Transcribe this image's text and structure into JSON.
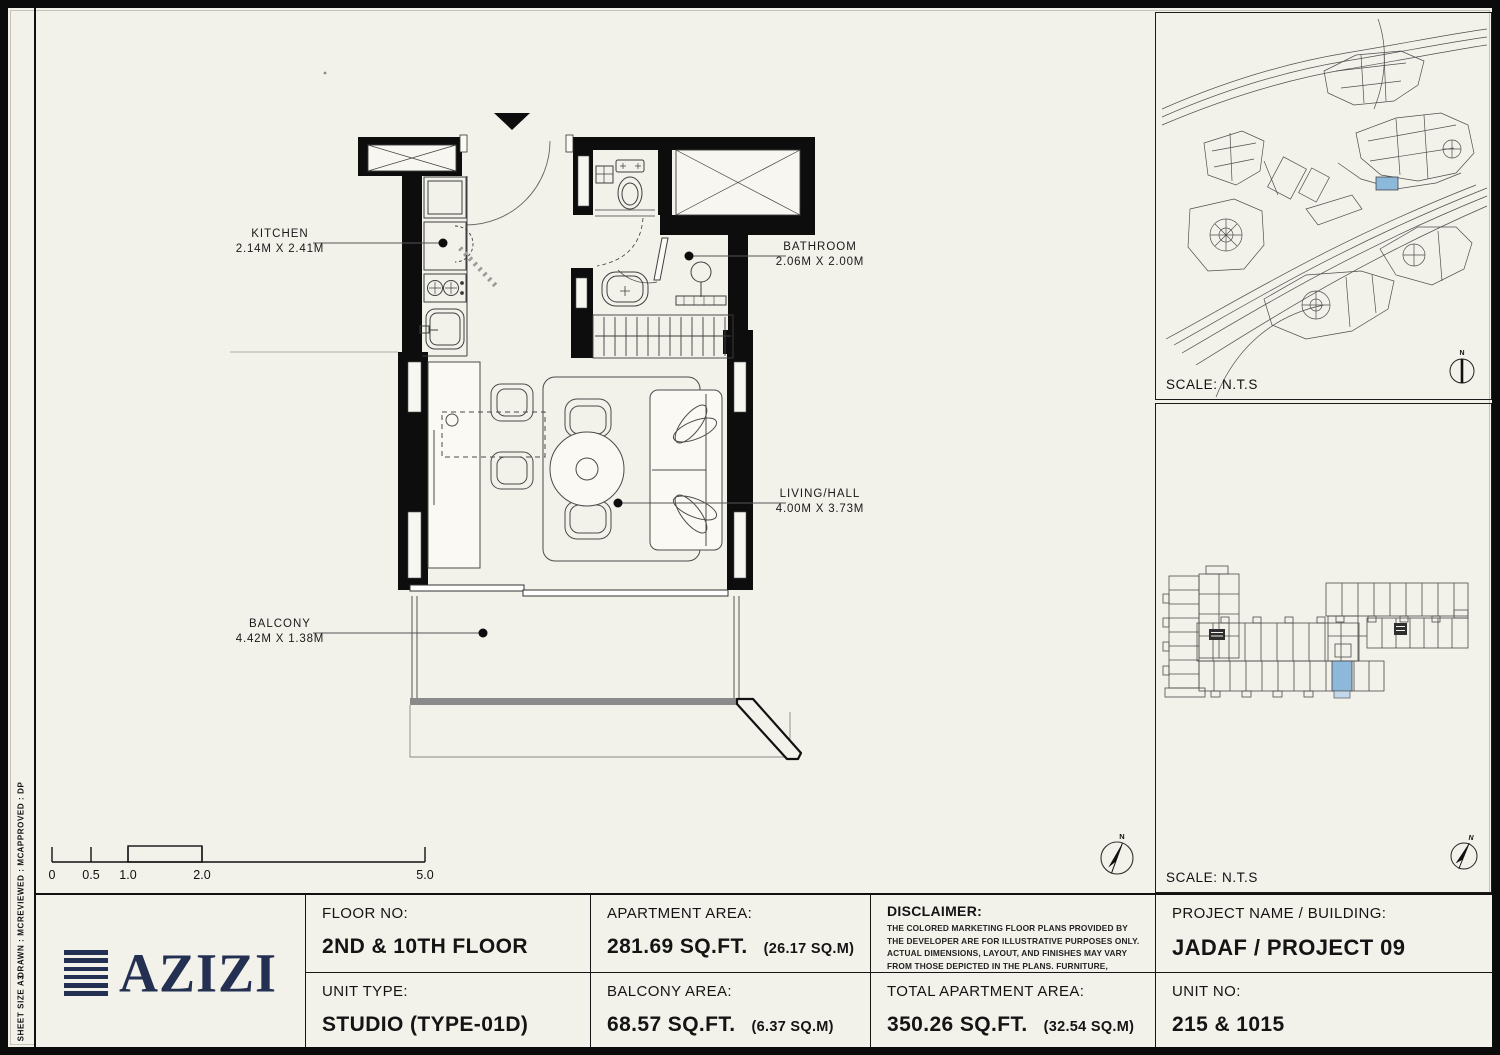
{
  "document": {
    "bg_color": "#f2f1ea",
    "ink_color": "#0d0d0d",
    "navy_color": "#243052",
    "highlight_blue": "#8cb8da"
  },
  "side_strip": {
    "items": [
      "APPROVED :  DP",
      "REVIEWED :  MC",
      "DRAWN :  MC",
      "SHEET SIZE A3"
    ]
  },
  "plan": {
    "rooms": [
      {
        "name": "KITCHEN",
        "dims": "2.14M X 2.41M"
      },
      {
        "name": "BATHROOM",
        "dims": "2.06M X 2.00M"
      },
      {
        "name": "LIVING/HALL",
        "dims": "4.00M X 3.73M"
      },
      {
        "name": "BALCONY",
        "dims": "4.42M X 1.38M"
      }
    ],
    "scale_ticks": [
      "0",
      "0.5",
      "1.0",
      "2.0",
      "5.0"
    ],
    "north": "N"
  },
  "panels": {
    "site_map": {
      "scale": "SCALE: N.T.S",
      "north": "N"
    },
    "key_plan": {
      "scale": "SCALE: N.T.S",
      "north": "N"
    }
  },
  "title_block": {
    "logo": "AZIZI",
    "floor_label": "FLOOR NO:",
    "floor_value": "2ND & 10TH FLOOR",
    "unit_type_label": "UNIT TYPE:",
    "unit_type_value": "STUDIO (TYPE-01D)",
    "apartment_area_label": "APARTMENT AREA:",
    "apartment_area_value": "281.69 SQ.FT.",
    "apartment_area_metric": "(26.17 SQ.M)",
    "balcony_area_label": "BALCONY AREA:",
    "balcony_area_value": "68.57 SQ.FT.",
    "balcony_area_metric": "(6.37 SQ.M)",
    "disclaimer_label": "DISCLAIMER:",
    "disclaimer_text": "THE COLORED MARKETING FLOOR PLANS PROVIDED BY THE DEVELOPER ARE FOR ILLUSTRATIVE PURPOSES ONLY. ACTUAL DIMENSIONS, LAYOUT, AND FINISHES MAY VARY FROM THOSE DEPICTED IN THE PLANS. FURNITURE, FIXTURES, AND EQUIPMENT SHOWN IN THE PLANS ARE FOR DECORATIVE PURPOSES ONLY AND ARE NOT INCLUDED IN THE PURCHASE OR LEASE OF THE PROPERTY. THE DEVELOPER RESERVES THE RIGHT TO MAKE MODIFICATIONS, REVISIONS, AND CHANGES TO THE FLOOR PLANS, SPECIFICATIONS, AND FEATURES WITHOUT PRIOR NOTICE.",
    "total_area_label": "TOTAL APARTMENT AREA:",
    "total_area_value": "350.26 SQ.FT.",
    "total_area_metric": "(32.54 SQ.M)",
    "project_label": "PROJECT NAME / BUILDING:",
    "project_value": "JADAF / PROJECT 09",
    "unit_no_label": "UNIT NO:",
    "unit_no_value": "215 & 1015"
  }
}
